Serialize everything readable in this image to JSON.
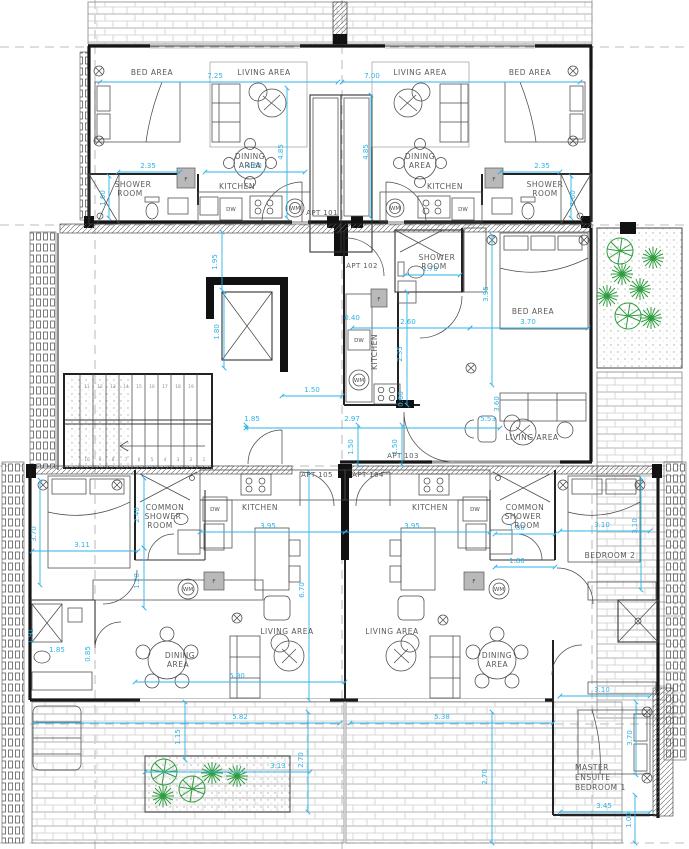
{
  "drawing": {
    "type": "apartment-floor-plan",
    "units": [
      "APT 101",
      "APT 102",
      "APT 103",
      "APT 104",
      "APT 105"
    ]
  },
  "colors": {
    "line": "#333333",
    "wall": "#111111",
    "dimension": "#2bb3e8",
    "plant_green": "#2f9e3f",
    "brick": "#cdcdcd",
    "grid": "#a9a9a9",
    "label": "#5a5a5a"
  },
  "labels": {
    "bed_area": "BED AREA",
    "living_area": "LIVING AREA",
    "dining": "DINING",
    "area": "AREA",
    "shower": "SHOWER",
    "room": "ROOM",
    "kitchen": "KITCHEN",
    "common": "COMMON",
    "bedroom2": "BEDROOM 2",
    "master": "MASTER",
    "ensuite": "ENSUITE",
    "bedroom1": "BEDROOM 1",
    "apt101": "APT 101",
    "apt102": "APT 102",
    "apt103": "APT 103",
    "apt104": "APT 104",
    "apt105": "APT 105",
    "dw": "DW",
    "wm": "WM",
    "f": "F"
  },
  "dims": {
    "d040": "0.40",
    "d060": "0.60",
    "d085": "0.85",
    "d100": "1.00",
    "d115": "1.15",
    "d120": "1.20",
    "d150": "1.50",
    "d160": "1.60",
    "d170": "1.70",
    "d180": "1.80",
    "d185": "1.85",
    "d191": "1.91",
    "d195": "1.95",
    "d235": "2.35",
    "d240": "2.40",
    "d260": "2.60",
    "d270": "2.70",
    "d297": "2.97",
    "d310": "3.10",
    "d311": "3.11",
    "d313": "3.13",
    "d345": "3.45",
    "d360": "3.60",
    "d370": "3.70",
    "d395": "3.95",
    "d460": "4.60",
    "d485": "4.85",
    "d538": "5.38",
    "d553": "5.53",
    "d582": "5.82",
    "d590": "5.90",
    "d670": "6.70",
    "d700": "7.00",
    "d725": "7.25"
  },
  "stairs": {
    "upper": [
      "11",
      "12",
      "13",
      "14",
      "15",
      "16",
      "17",
      "18",
      "19"
    ],
    "lower": [
      "10",
      "9",
      "8",
      "7",
      "6",
      "5",
      "4",
      "3",
      "2",
      "1"
    ]
  }
}
